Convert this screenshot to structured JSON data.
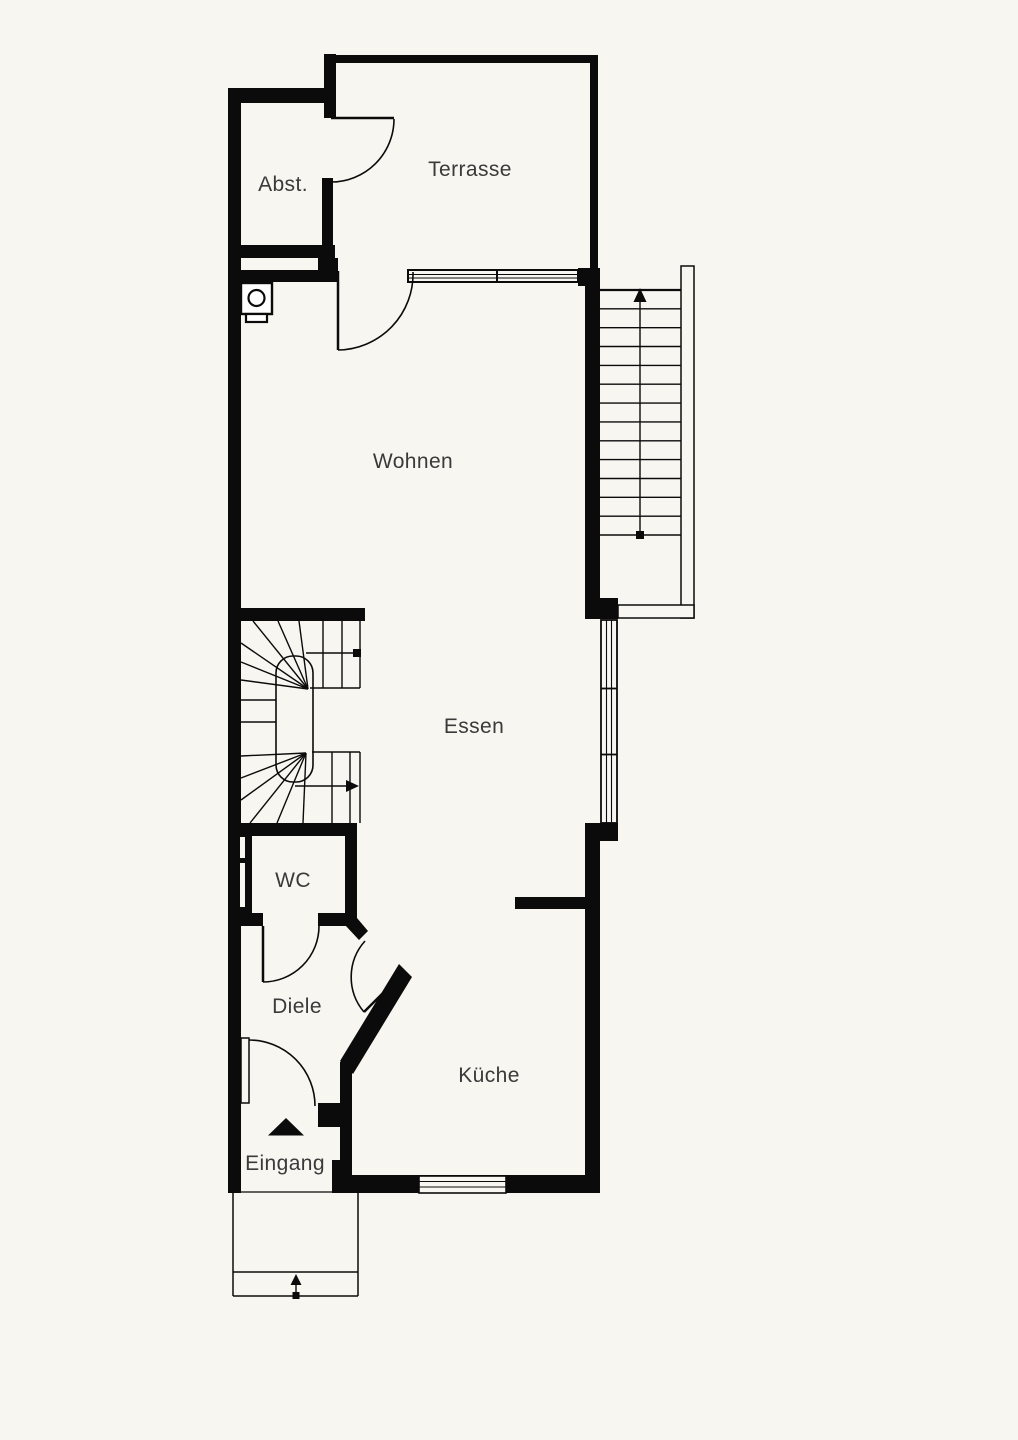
{
  "plan": {
    "title": "Ground floor plan",
    "rooms": {
      "abstellraum": {
        "label": "Abst."
      },
      "terrasse": {
        "label": "Terrasse"
      },
      "wohnen": {
        "label": "Wohnen"
      },
      "essen": {
        "label": "Essen"
      },
      "wc": {
        "label": "WC"
      },
      "diele": {
        "label": "Diele"
      },
      "kueche": {
        "label": "Küche"
      },
      "eingang": {
        "label": "Eingang"
      }
    },
    "stairs": {
      "exterior_straight": {
        "treads": 13,
        "direction": "up"
      },
      "interior_winder": {
        "type": "double-winder",
        "direction": "up"
      }
    },
    "symbols": [
      "boiler-icon",
      "entrance-triangle-icon",
      "stair-up-arrow-icon",
      "entry-step-arrow-icon",
      "door-swing-arc",
      "window-glazing-lines"
    ],
    "colors": {
      "background": "#f8f6f1",
      "wall": "#0b0b0b",
      "text": "#3a3a3a"
    }
  }
}
